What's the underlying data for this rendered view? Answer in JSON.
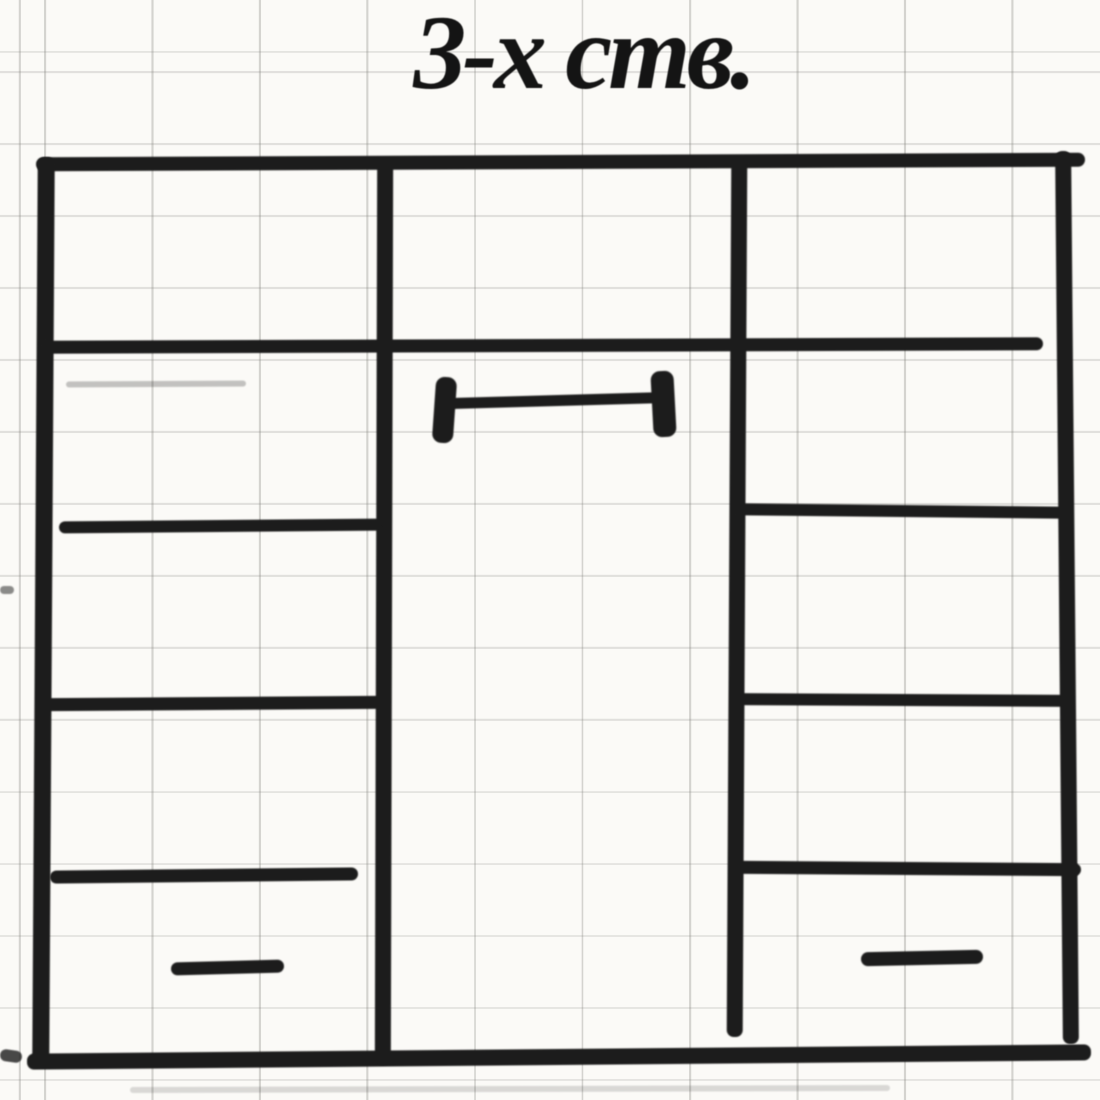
{
  "title": {
    "text": "3-х ств."
  },
  "colors": {
    "paper": "#fbfaf7",
    "ink": "#1c1c1c",
    "grid": "#787873",
    "title_ink": "#141414"
  },
  "sketch": {
    "kind": "hand-drawn-wardrobe-front-elevation",
    "strokes": [
      {
        "name": "wardrobe-top-edge",
        "x": 36,
        "y": 155,
        "w": 1049,
        "h": 14,
        "r": -0.25
      },
      {
        "name": "wardrobe-left-wall",
        "x": 35,
        "y": 157,
        "w": 17,
        "h": 908,
        "r": 0.35
      },
      {
        "name": "wardrobe-right-wall",
        "x": 1059,
        "y": 151,
        "w": 16,
        "h": 893,
        "r": -0.5
      },
      {
        "name": "wardrobe-bottom-edge",
        "x": 27,
        "y": 1049,
        "w": 1064,
        "h": 16,
        "r": -0.5
      },
      {
        "name": "divider-left",
        "x": 376,
        "y": 159,
        "w": 16,
        "h": 906,
        "r": 0.15
      },
      {
        "name": "divider-right",
        "x": 729,
        "y": 157,
        "w": 16,
        "h": 880,
        "r": 0.3
      },
      {
        "name": "mezzanine-shelf-line",
        "x": 40,
        "y": 339,
        "w": 1003,
        "h": 13,
        "r": -0.2
      },
      {
        "name": "left-shelf-1",
        "x": 59,
        "y": 520,
        "w": 323,
        "h": 12,
        "r": -0.5
      },
      {
        "name": "left-shelf-2",
        "x": 38,
        "y": 697,
        "w": 352,
        "h": 13,
        "r": -0.4
      },
      {
        "name": "left-shelf-3",
        "x": 50,
        "y": 869,
        "w": 308,
        "h": 13,
        "r": -0.6
      },
      {
        "name": "left-drawer-handle",
        "x": 171,
        "y": 961,
        "w": 113,
        "h": 13,
        "r": -1.5,
        "br": 7
      },
      {
        "name": "hanging-rail-bar",
        "x": 447,
        "y": 395,
        "w": 223,
        "h": 11,
        "r": -1.6
      },
      {
        "name": "hanging-rail-end-left",
        "x": 434,
        "y": 377,
        "w": 21,
        "h": 66,
        "r": 4,
        "br": 9
      },
      {
        "name": "hanging-rail-end-right",
        "x": 652,
        "y": 371,
        "w": 23,
        "h": 66,
        "r": -3,
        "br": 9
      },
      {
        "name": "right-shelf-1",
        "x": 735,
        "y": 505,
        "w": 332,
        "h": 12,
        "r": 0.6
      },
      {
        "name": "right-shelf-2",
        "x": 733,
        "y": 694,
        "w": 340,
        "h": 12,
        "r": 0.3
      },
      {
        "name": "right-shelf-3",
        "x": 736,
        "y": 862,
        "w": 345,
        "h": 13,
        "r": 0.4
      },
      {
        "name": "right-drawer-handle",
        "x": 861,
        "y": 951,
        "w": 122,
        "h": 14,
        "r": -1.2,
        "br": 7
      },
      {
        "name": "stray-mark-left-bottom",
        "x": 0,
        "y": 1050,
        "w": 22,
        "h": 12,
        "r": 8,
        "o": 0.8
      },
      {
        "name": "stray-mark-left-middle",
        "x": 0,
        "y": 586,
        "w": 14,
        "h": 8,
        "r": 0,
        "o": 0.5
      },
      {
        "name": "stray-pencil-smudge",
        "x": 66,
        "y": 381,
        "w": 180,
        "h": 6,
        "r": -0.3,
        "o": 0.25
      },
      {
        "name": "stray-photo-smudge-bottom",
        "x": 130,
        "y": 1086,
        "w": 760,
        "h": 6,
        "r": -0.15,
        "o": 0.15
      }
    ]
  }
}
